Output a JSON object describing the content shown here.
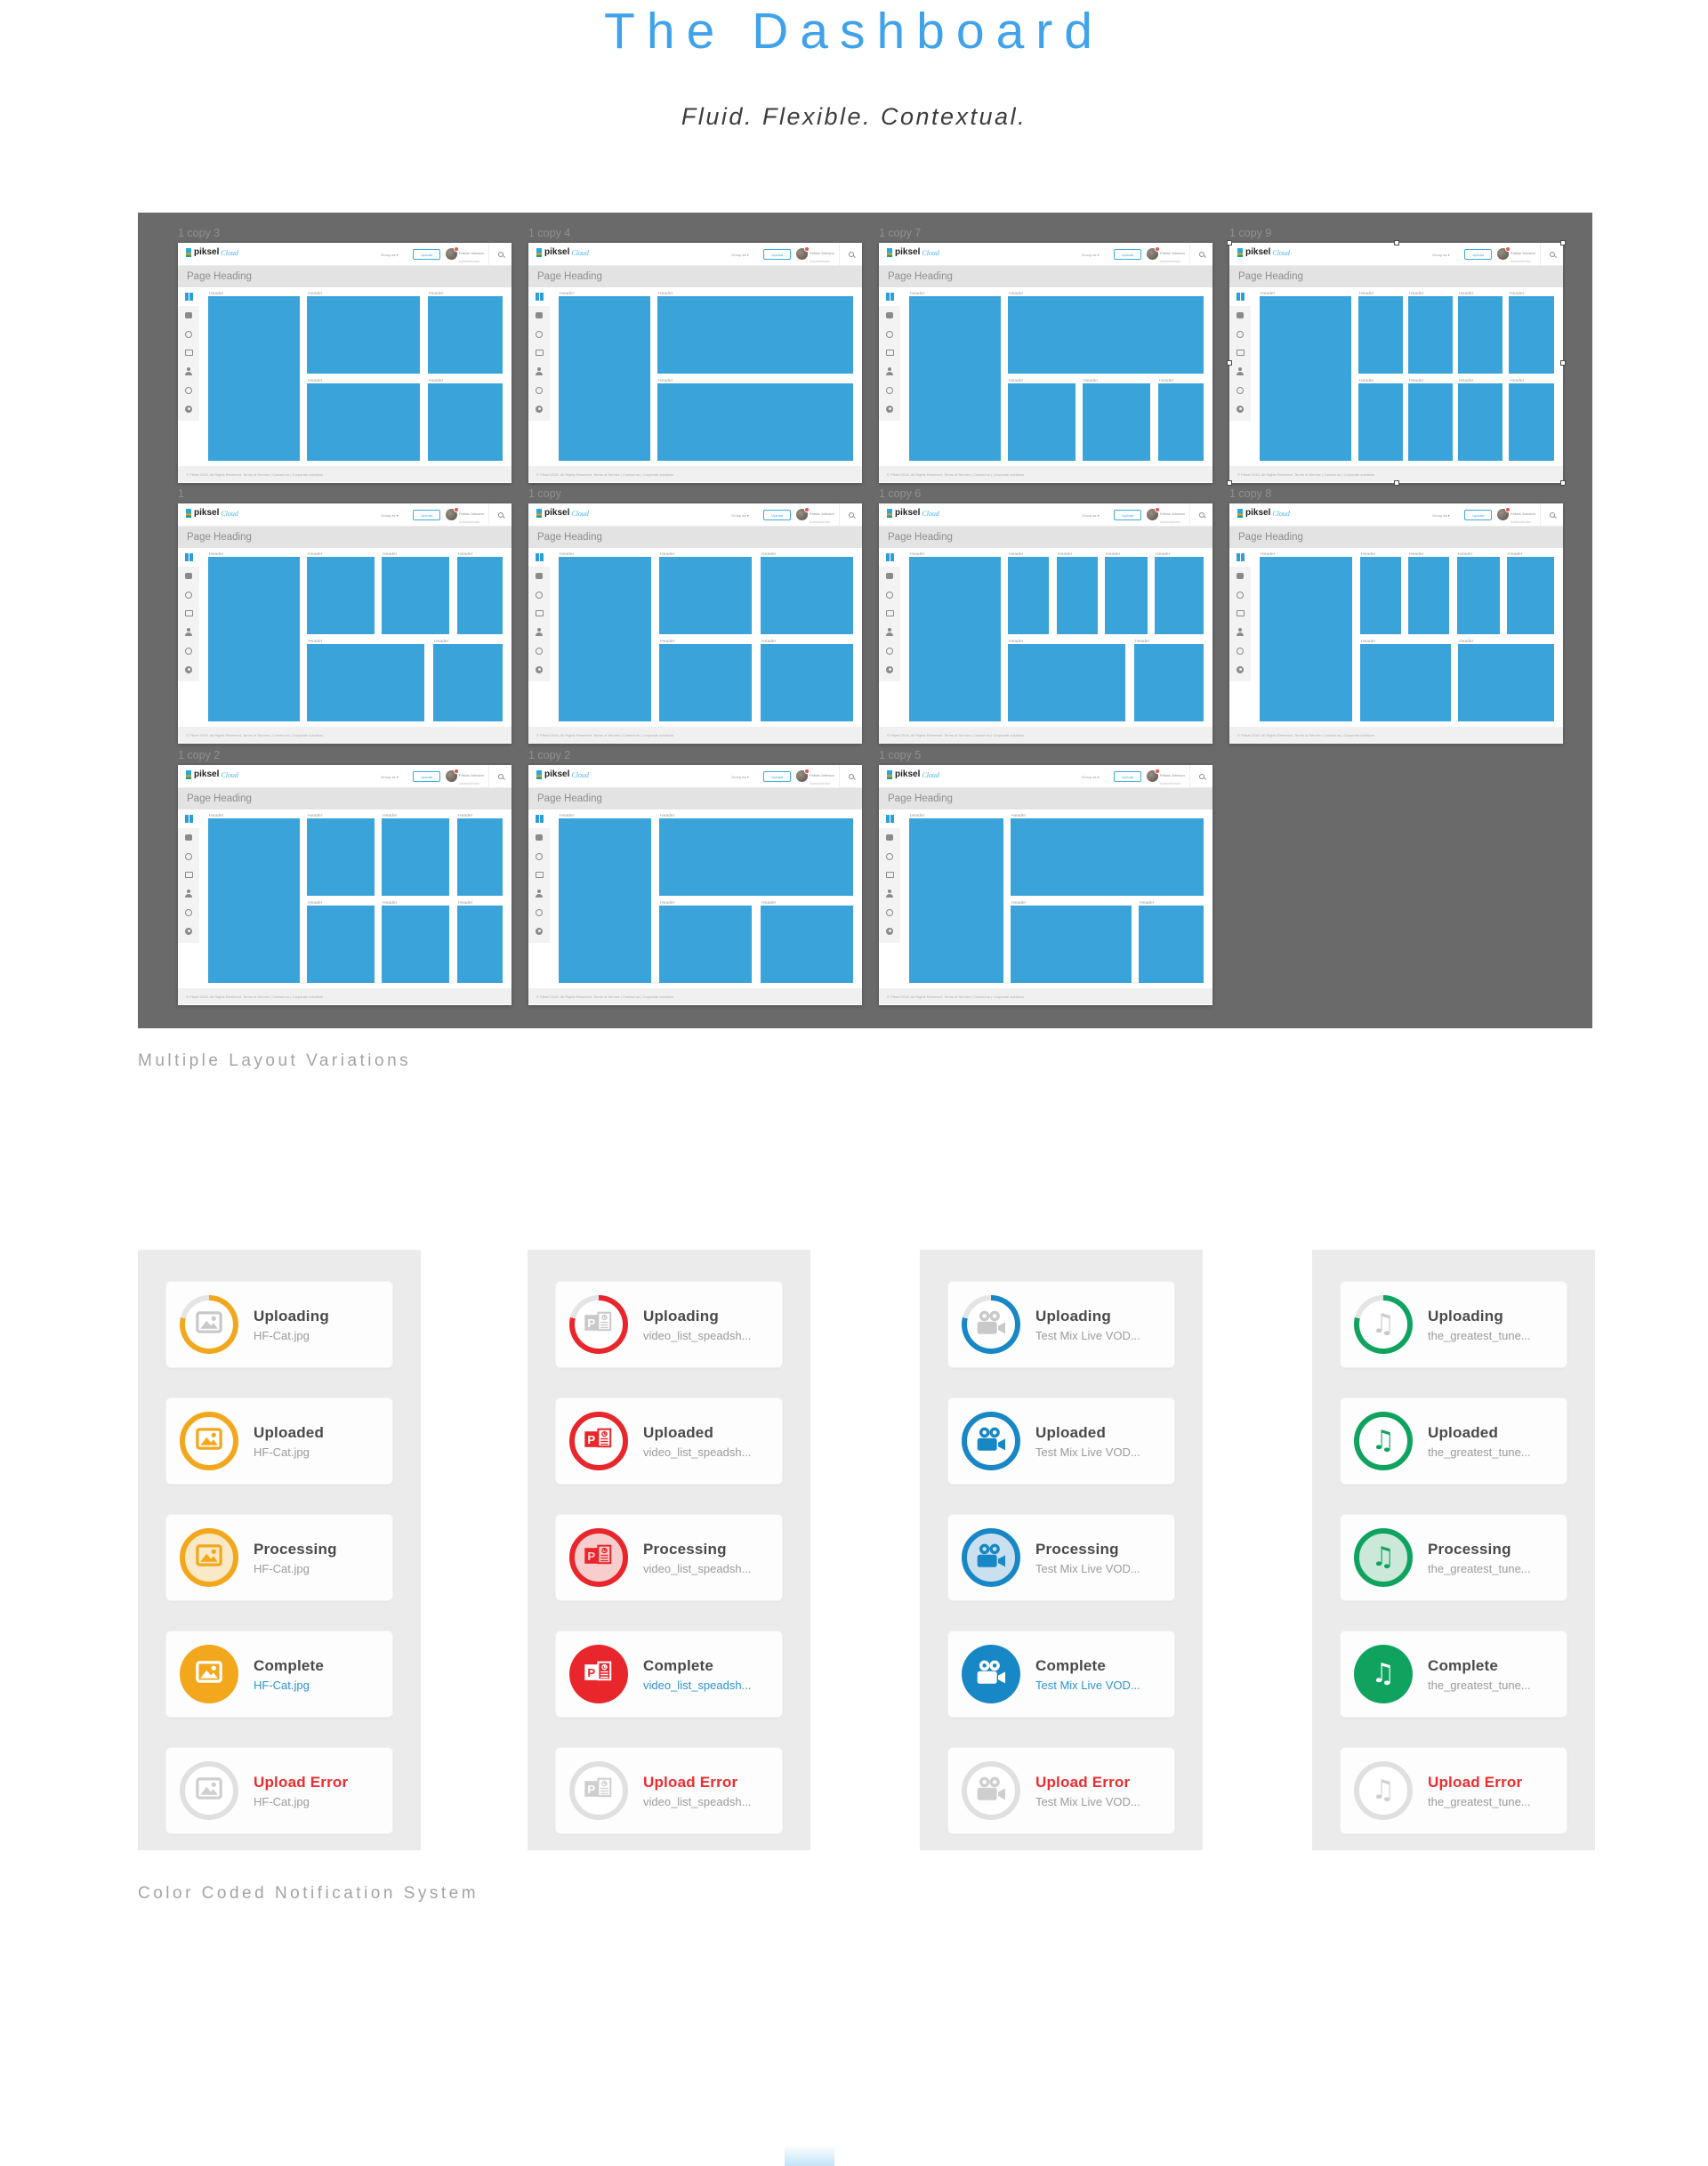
{
  "page": {
    "title": "The Dashboard",
    "subtitle": "Fluid. Flexible. Contextual."
  },
  "colors": {
    "title_blue": "#3FA2EA",
    "block_blue": "#39A3DA",
    "showcase_bg": "#6A6A6A",
    "panel_bg": "#EBEBEB",
    "error_red": "#ED2C30",
    "link_blue": "#2E93D4"
  },
  "layout_section": {
    "caption": "Multiple Layout Variations",
    "chrome": {
      "logo_text": "piksel",
      "logo_suffix": "Cloud",
      "group_by": "Group as ▾",
      "upload": "Upload",
      "user_name": "Felicia Johnson",
      "user_role": "Administrator",
      "page_heading": "Page Heading",
      "block_label": "Header",
      "footer": "© Piksel 2015. All Rights Reserved.    Terms of Service   |   Contact us   |   Corporate solutions"
    },
    "mockups": [
      {
        "label": "1 copy 3",
        "selected": false,
        "blocks": [
          [
            0,
            0,
            31,
            100
          ],
          [
            33.5,
            0,
            38.5,
            47
          ],
          [
            74.5,
            0,
            25.5,
            47
          ],
          [
            33.5,
            53,
            38.5,
            47
          ],
          [
            74.5,
            53,
            25.5,
            47
          ]
        ]
      },
      {
        "label": "1 copy 4",
        "selected": false,
        "blocks": [
          [
            0,
            0,
            31,
            100
          ],
          [
            33.5,
            0,
            66.5,
            47
          ],
          [
            33.5,
            53,
            66.5,
            47
          ]
        ]
      },
      {
        "label": "1 copy 7",
        "selected": false,
        "blocks": [
          [
            0,
            0,
            31,
            100
          ],
          [
            33.5,
            0,
            66.5,
            47
          ],
          [
            33.5,
            53,
            23,
            47
          ],
          [
            59,
            53,
            23,
            47
          ],
          [
            84.5,
            53,
            15.5,
            47
          ]
        ]
      },
      {
        "label": "1 copy 9",
        "selected": true,
        "blocks": [
          [
            0,
            0,
            31,
            100
          ],
          [
            33.5,
            0,
            15,
            47
          ],
          [
            50.5,
            0,
            15,
            47
          ],
          [
            67.5,
            0,
            15,
            47
          ],
          [
            84.5,
            0,
            15.5,
            47
          ],
          [
            33.5,
            53,
            15,
            47
          ],
          [
            50.5,
            53,
            15,
            47
          ],
          [
            67.5,
            53,
            15,
            47
          ],
          [
            84.5,
            53,
            15.5,
            47
          ]
        ]
      },
      {
        "label": "1",
        "selected": false,
        "blocks": [
          [
            0,
            0,
            31,
            100
          ],
          [
            33.5,
            0,
            23,
            47
          ],
          [
            59,
            0,
            23,
            47
          ],
          [
            84.5,
            0,
            15.5,
            47
          ],
          [
            33.5,
            53,
            40,
            47
          ],
          [
            76.5,
            53,
            23.5,
            47
          ]
        ]
      },
      {
        "label": "1 copy",
        "selected": false,
        "blocks": [
          [
            0,
            0,
            31.5,
            100
          ],
          [
            34,
            0,
            31.5,
            47
          ],
          [
            68.5,
            0,
            31.5,
            47
          ],
          [
            34,
            53,
            31.5,
            47
          ],
          [
            68.5,
            53,
            31.5,
            47
          ]
        ]
      },
      {
        "label": "1 copy 6",
        "selected": false,
        "blocks": [
          [
            0,
            0,
            31,
            100
          ],
          [
            33.5,
            0,
            14,
            47
          ],
          [
            50,
            0,
            14,
            47
          ],
          [
            66.5,
            0,
            14.5,
            47
          ],
          [
            83.5,
            0,
            16.5,
            47
          ],
          [
            33.5,
            53,
            40,
            47
          ],
          [
            76.5,
            53,
            23.5,
            47
          ]
        ]
      },
      {
        "label": "1 copy 8",
        "selected": false,
        "blocks": [
          [
            0,
            0,
            31.5,
            100
          ],
          [
            34,
            0,
            14,
            47
          ],
          [
            50.5,
            0,
            14,
            47
          ],
          [
            67,
            0,
            14.5,
            47
          ],
          [
            84,
            0,
            16,
            47
          ],
          [
            34,
            53,
            31,
            47
          ],
          [
            67.5,
            53,
            32.5,
            47
          ]
        ]
      },
      {
        "label": "1 copy 2",
        "selected": false,
        "blocks": [
          [
            0,
            0,
            31,
            100
          ],
          [
            33.5,
            0,
            23,
            47
          ],
          [
            59,
            0,
            23,
            47
          ],
          [
            84.5,
            0,
            15.5,
            47
          ],
          [
            33.5,
            53,
            23,
            47
          ],
          [
            59,
            53,
            23,
            47
          ],
          [
            84.5,
            53,
            15.5,
            47
          ]
        ]
      },
      {
        "label": "1 copy 2",
        "selected": false,
        "blocks": [
          [
            0,
            0,
            31.5,
            100
          ],
          [
            34,
            0,
            66,
            47
          ],
          [
            34,
            53,
            31.5,
            47
          ],
          [
            68.5,
            53,
            31.5,
            47
          ]
        ]
      },
      {
        "label": "1 copy 5",
        "selected": false,
        "blocks": [
          [
            0,
            0,
            32,
            100
          ],
          [
            34.5,
            0,
            65.5,
            47
          ],
          [
            34.5,
            53,
            41,
            47
          ],
          [
            78,
            53,
            22,
            47
          ]
        ]
      }
    ]
  },
  "notification_section": {
    "caption": "Color Coded Notification System",
    "panels": [
      {
        "icon": "image-icon",
        "color": "#F2A71C",
        "tint": "#FAE9C6",
        "filename": "HF-Cat.jpg",
        "items": [
          {
            "status": "Uploading",
            "style": "progress",
            "link": false,
            "error": false
          },
          {
            "status": "Uploaded",
            "style": "ring",
            "link": false,
            "error": false
          },
          {
            "status": "Processing",
            "style": "tint",
            "link": false,
            "error": false
          },
          {
            "status": "Complete",
            "style": "solid",
            "link": true,
            "error": false
          },
          {
            "status": "Upload Error",
            "style": "off",
            "link": false,
            "error": true
          }
        ]
      },
      {
        "icon": "powerpoint-icon",
        "color": "#E8262B",
        "tint": "#F8CDCE",
        "filename": "video_list_speadsh...",
        "items": [
          {
            "status": "Uploading",
            "style": "progress",
            "link": false,
            "error": false
          },
          {
            "status": "Uploaded",
            "style": "ring",
            "link": false,
            "error": false
          },
          {
            "status": "Processing",
            "style": "tint",
            "link": false,
            "error": false
          },
          {
            "status": "Complete",
            "style": "solid",
            "link": true,
            "error": false
          },
          {
            "status": "Upload Error",
            "style": "off",
            "link": false,
            "error": true
          }
        ]
      },
      {
        "icon": "video-camera-icon",
        "color": "#1787C5",
        "tint": "#CBE0EF",
        "filename": "Test Mix Live VOD...",
        "items": [
          {
            "status": "Uploading",
            "style": "progress",
            "link": false,
            "error": false
          },
          {
            "status": "Uploaded",
            "style": "ring",
            "link": false,
            "error": false
          },
          {
            "status": "Processing",
            "style": "tint",
            "link": false,
            "error": false
          },
          {
            "status": "Complete",
            "style": "solid",
            "link": true,
            "error": false
          },
          {
            "status": "Upload Error",
            "style": "off",
            "link": false,
            "error": true
          }
        ]
      },
      {
        "icon": "music-note-icon",
        "color": "#10A35F",
        "tint": "#CBE8D9",
        "filename": "the_greatest_tune...",
        "items": [
          {
            "status": "Uploading",
            "style": "progress",
            "link": false,
            "error": false
          },
          {
            "status": "Uploaded",
            "style": "ring",
            "link": false,
            "error": false
          },
          {
            "status": "Processing",
            "style": "tint",
            "link": false,
            "error": false
          },
          {
            "status": "Complete",
            "style": "solid",
            "link": false,
            "error": false
          },
          {
            "status": "Upload Error",
            "style": "off",
            "link": false,
            "error": true
          }
        ]
      }
    ]
  }
}
